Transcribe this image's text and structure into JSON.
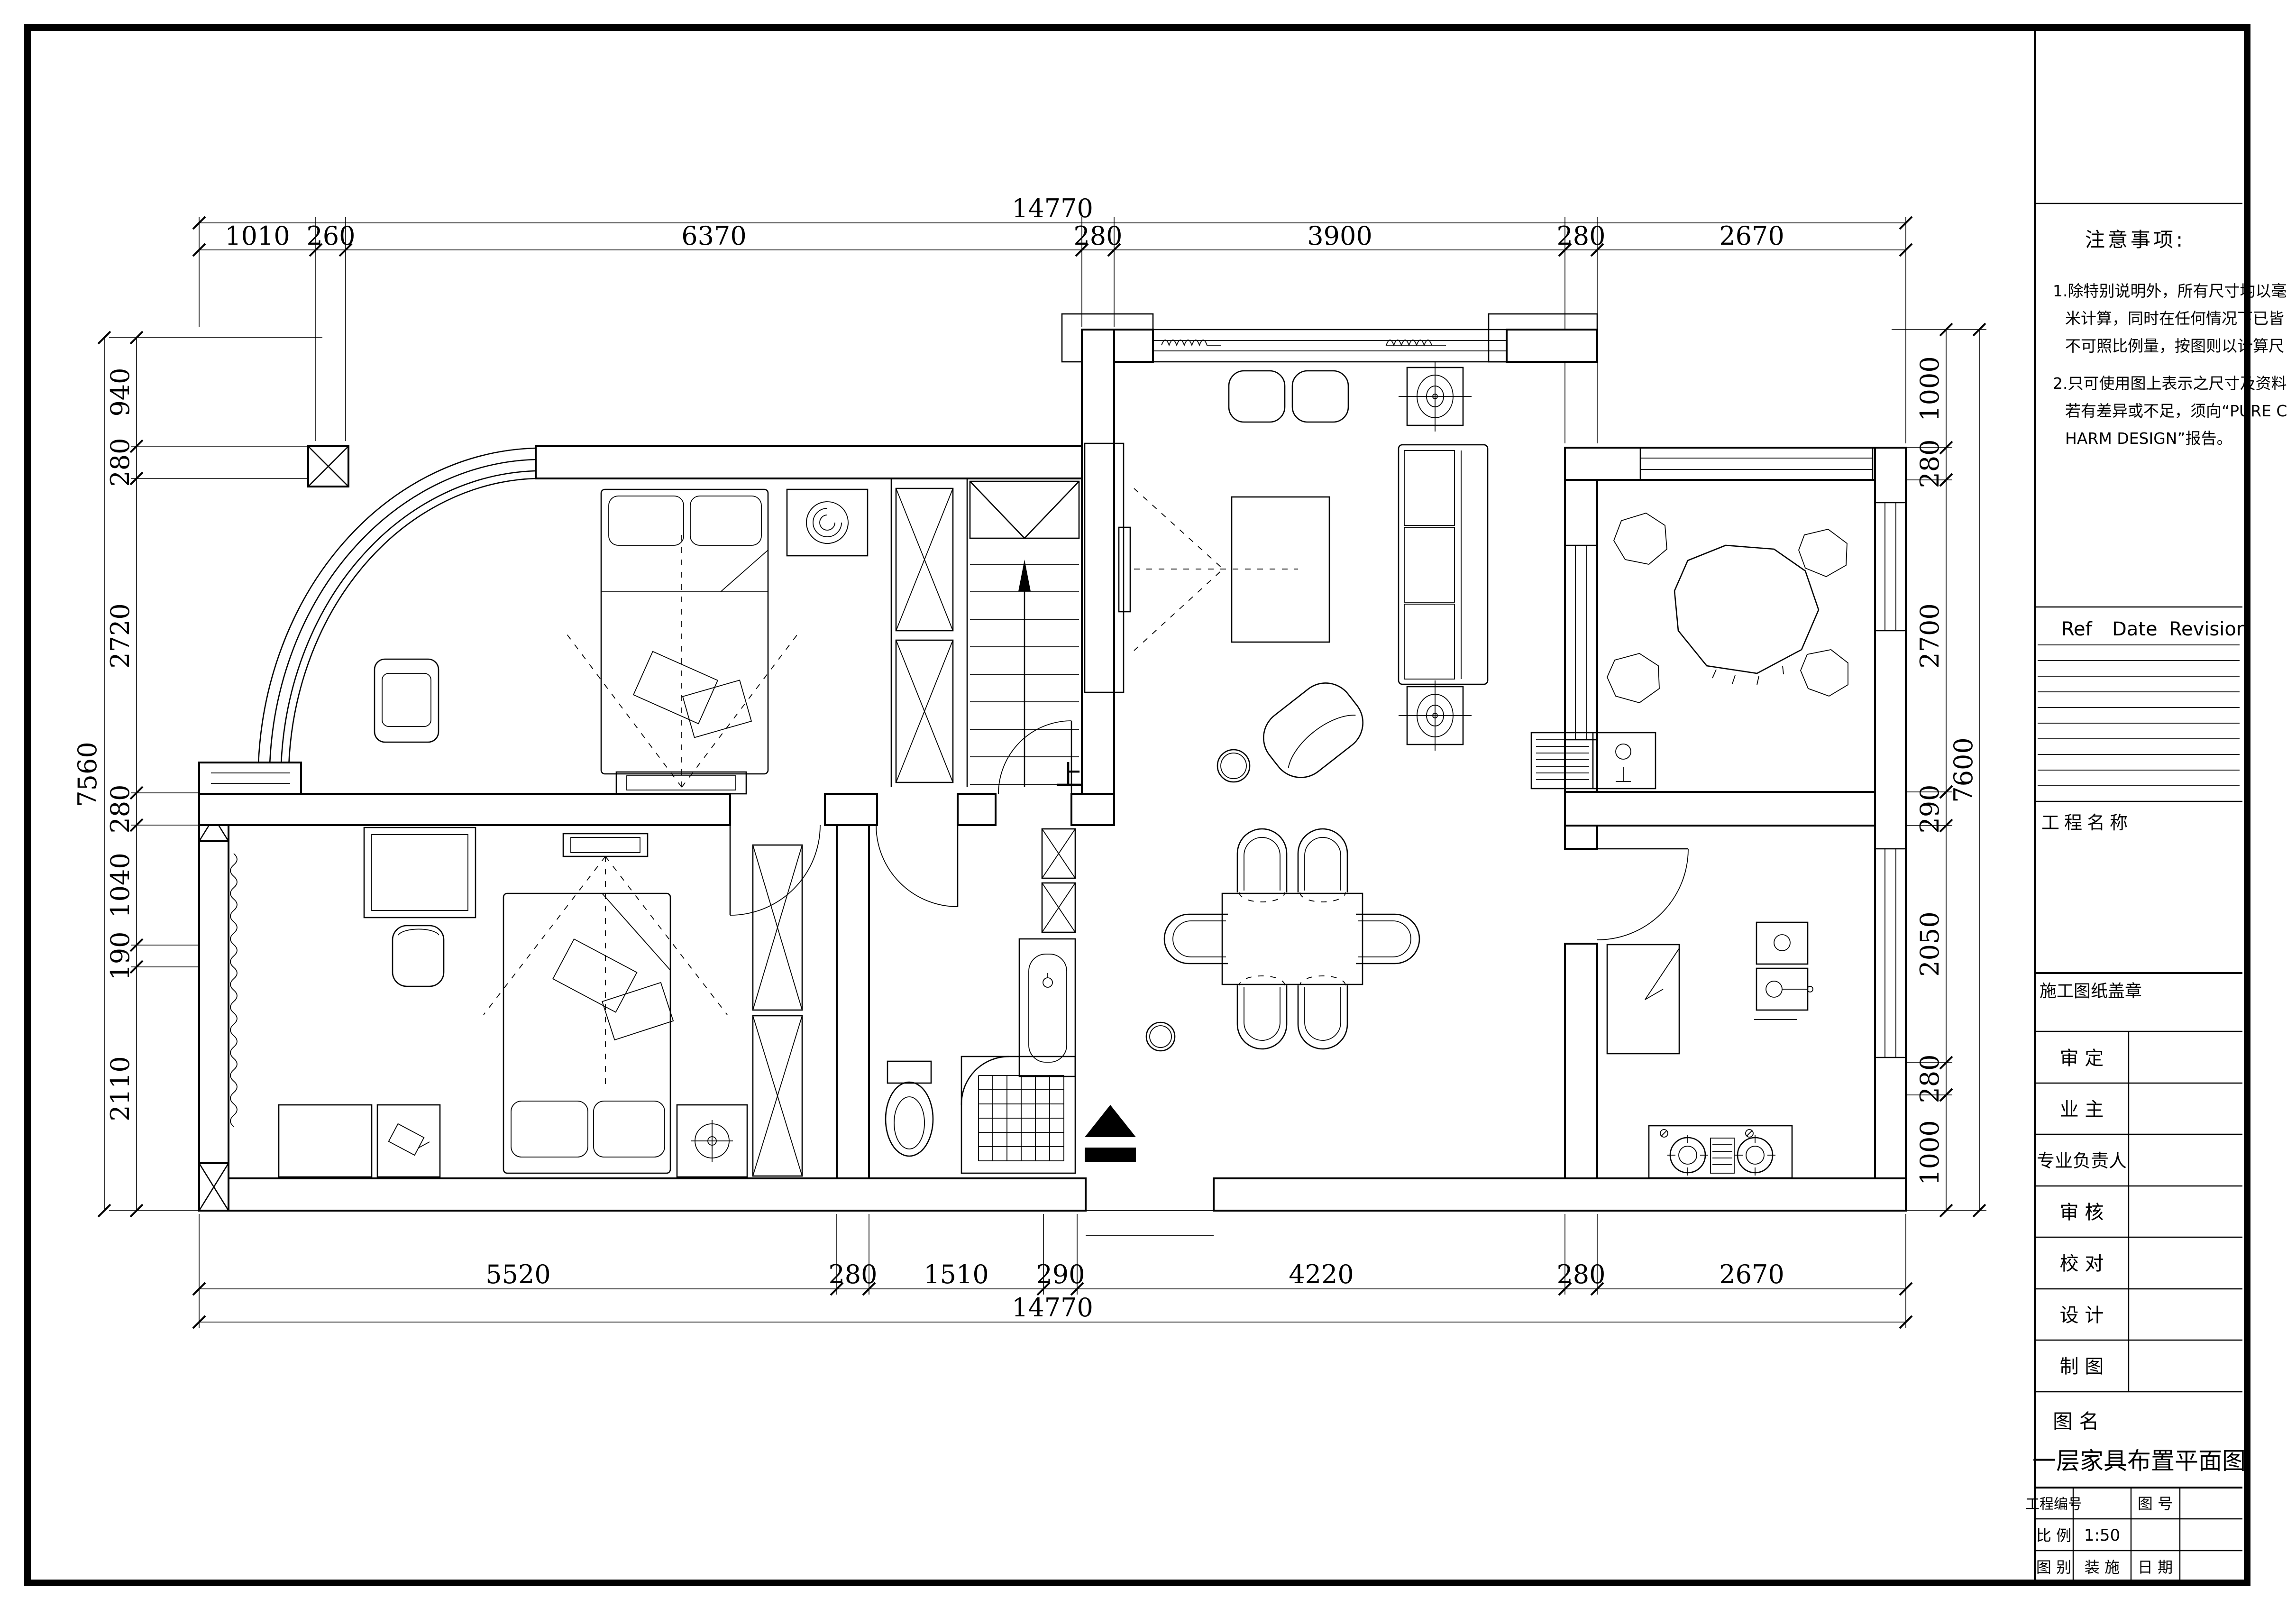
{
  "sheet": {
    "drawing_title": "一层家具布置平面图"
  },
  "plan": {
    "stairs_up_label": "上"
  },
  "dims": {
    "top": {
      "total": "14770",
      "segments": [
        "1010",
        "260",
        "6370",
        "280",
        "3900",
        "280",
        "2670"
      ]
    },
    "bottom": {
      "total": "14770",
      "segments": [
        "5520",
        "280",
        "1510",
        "290",
        "4220",
        "280",
        "2670"
      ]
    },
    "left": {
      "total": "7560",
      "segments": [
        "940",
        "280",
        "2720",
        "280",
        "1040",
        "190",
        "2110"
      ]
    },
    "right": {
      "total": "7600",
      "segments": [
        "1000",
        "280",
        "2700",
        "290",
        "2050",
        "280",
        "1000"
      ]
    }
  },
  "title_block": {
    "notes": {
      "title": "注意事项:",
      "lines": [
        "1.除特别说明外，所有尺寸均以毫",
        "米计算，同时在任何情况下已皆",
        "不可照比例量，按图则以计算尺",
        "2.只可使用图上表示之尺寸及资料",
        "若有差异或不足，须向“PURE C",
        "HARM DESIGN”报告。"
      ]
    },
    "revision": {
      "ref": "Ref",
      "date": "Date",
      "revision": "Revision"
    },
    "project_name_label": "工程名称",
    "seal_label": "施工图纸盖章",
    "sign_rows": [
      {
        "label": "审    定"
      },
      {
        "label": "业    主"
      },
      {
        "label": "专业负责人"
      },
      {
        "label": "审    核"
      },
      {
        "label": "校    对"
      },
      {
        "label": "设    计"
      },
      {
        "label": "制    图"
      }
    ],
    "drawing_name_label": "图  名",
    "drawing_name": "一层家具布置平面图",
    "fields": {
      "project_no_label": "工程编号",
      "drawing_no_label": "图  号",
      "scale_label": "比  例",
      "scale_value": "1:50",
      "category_label": "图  别",
      "category_value": "装  施",
      "date_label": "日  期"
    }
  }
}
